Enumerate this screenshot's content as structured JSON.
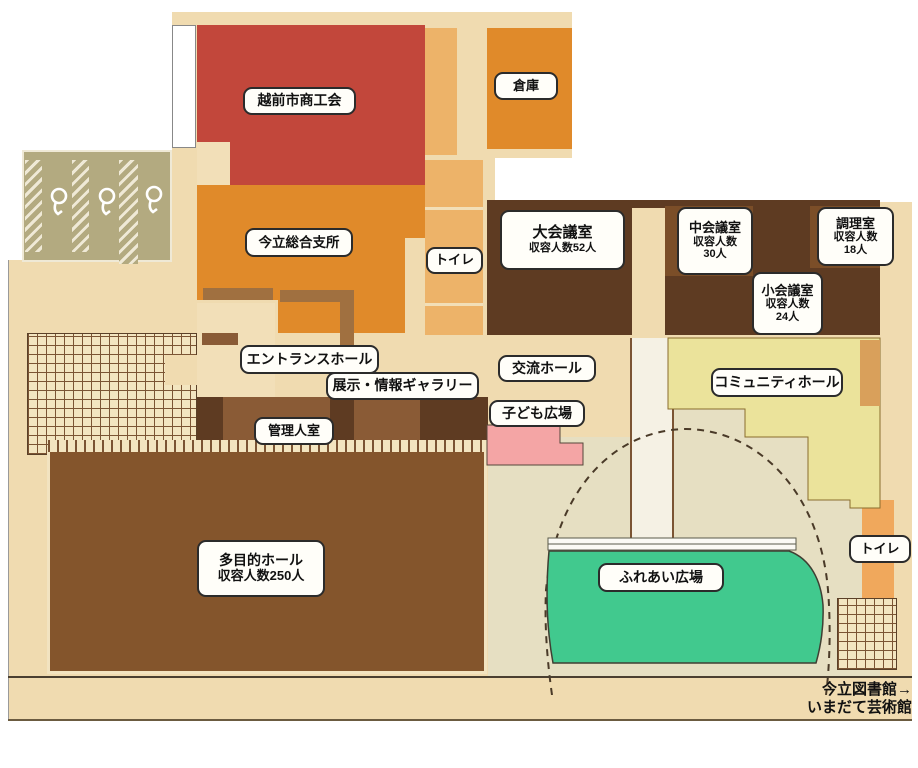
{
  "floorplan": {
    "rooms": {
      "chamber_of_commerce": {
        "label": "越前市商工会"
      },
      "storage": {
        "label": "倉庫"
      },
      "branch_office": {
        "label": "今立総合支所"
      },
      "toilet_central": {
        "label": "トイレ"
      },
      "large_meeting_room": {
        "label": "大会議室",
        "capacity": "収容人数52人"
      },
      "medium_meeting_room": {
        "label": "中会議室",
        "capacity_label": "収容人数",
        "capacity_value": "30人"
      },
      "cooking_room": {
        "label": "調理室",
        "capacity_label": "収容人数",
        "capacity_value": "18人"
      },
      "small_meeting_room": {
        "label": "小会議室",
        "capacity_label": "収容人数",
        "capacity_value": "24人"
      },
      "entrance_hall": {
        "label": "エントランスホール"
      },
      "exhibition_gallery": {
        "label": "展示・情報ギャラリー"
      },
      "exchange_hall": {
        "label": "交流ホール"
      },
      "kids_plaza": {
        "label": "子ども広場"
      },
      "caretaker_room": {
        "label": "管理人室"
      },
      "community_hall": {
        "label": "コミュニティホール"
      },
      "multipurpose_hall": {
        "label": "多目的ホール",
        "capacity": "収容人数250人"
      },
      "fureai_plaza": {
        "label": "ふれあい広場"
      },
      "toilet_east": {
        "label": "トイレ"
      }
    },
    "caption": {
      "line1": "今立図書館→",
      "line2": "いまだて芸術館"
    },
    "icons": {
      "toilet_fixture": "toilet-fixture-icon"
    },
    "colors": {
      "red_room": "#C2473B",
      "orange_room": "#E08A2A",
      "light_orange": "#EDB369",
      "dark_brown_room": "#5E3B22",
      "medium_brown_room": "#7B4E28",
      "hall_brown": "#84552C",
      "tan_background": "#F0DBB0",
      "cream": "#F2DFB8",
      "stall_khaki": "#B3AA80",
      "plaza_khaki": "#E6DFC2",
      "community_yellow": "#EBE39B",
      "plaza_green": "#41C98E",
      "kids_pink": "#F4A5A5",
      "toilet_strip_orange": "#F0A85C",
      "outline_dark": "#4a3a28"
    }
  }
}
